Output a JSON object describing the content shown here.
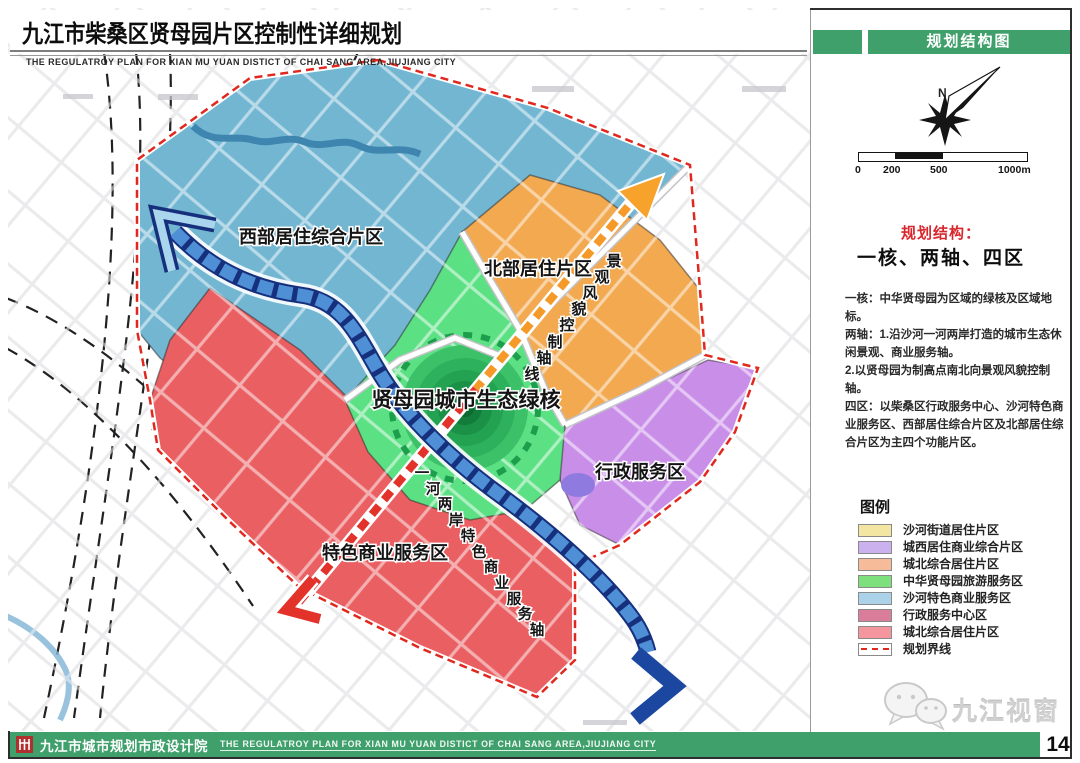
{
  "page": {
    "number": "14"
  },
  "header": {
    "title": "九江市柴桑区贤母园片区控制性详细规划",
    "subtitle": "THE REGULATROY PLAN FOR XIAN MU YUAN DISTICT OF CHAI SANG AREA,JIUJIANG CITY"
  },
  "footer": {
    "org": "九江市城市规划市政设计院",
    "subtitle": "THE REGULATROY PLAN FOR XIAN MU YUAN DISTICT OF CHAI SANG AREA,JIUJIANG CITY"
  },
  "sidebar": {
    "panel_title": "规划结构图",
    "compass": {
      "north_label": "N"
    },
    "scale_bar": {
      "labels": [
        "0",
        "200",
        "500",
        "1000m"
      ]
    },
    "structure": {
      "heading": "规划结构：",
      "subheading": "一核、两轴、四区",
      "body": "一核：中华贤母园为区域的绿核及区域地标。\n两轴：1.沿沙河一河两岸打造的城市生态休闲景观、商业服务轴。\n2.以贤母园为制高点南北向景观风貌控制轴。\n四区：以柴桑区行政服务中心、沙河特色商业服务区、西部居住综合片区及北部居住综合片区为主四个功能片区。"
    },
    "legend": {
      "title": "图例",
      "items": [
        {
          "label": "沙河街道居住片区",
          "color": "#f3e5a2"
        },
        {
          "label": "城西居住商业综合片区",
          "color": "#cbb2ee"
        },
        {
          "label": "城北综合居住片区",
          "color": "#f6bb98"
        },
        {
          "label": "中华贤母园旅游服务区",
          "color": "#7de07d"
        },
        {
          "label": "沙河特色商业服务区",
          "color": "#abd2e8"
        },
        {
          "label": "行政服务中心区",
          "color": "#d97d9b"
        },
        {
          "label": "城北综合居住片区",
          "color": "#f5959d"
        },
        {
          "label": "规划界线",
          "color": "boundary-dash"
        }
      ]
    },
    "watermark": "九江视窗"
  },
  "map": {
    "regions": {
      "west": {
        "label": "西部居住综合片区",
        "color": "#72b6d2"
      },
      "north": {
        "label": "北部居住片区",
        "color": "#f2a950"
      },
      "green_core": {
        "label": "贤母园城市生态绿核",
        "color": "#5ce084"
      },
      "admin": {
        "label": "行政服务区",
        "color": "#c98fe8"
      },
      "commercial": {
        "label": "特色商业服务区",
        "color": "#e95f62"
      }
    },
    "axes": {
      "view": {
        "label": "景观风貌控制轴线",
        "chars": [
          "景",
          "观",
          "风",
          "貌",
          "控",
          "制",
          "轴",
          "线"
        ],
        "color_top": "#f59a28",
        "color_bottom": "#e2322a"
      },
      "river": {
        "label": "一河两岸特色商业服务轴",
        "chars": [
          "一",
          "河",
          "两",
          "岸",
          "特",
          "色",
          "商",
          "业",
          "服",
          "务",
          "轴"
        ],
        "color": "#4f8fd6"
      }
    },
    "boundary_color": "#e0281e"
  }
}
